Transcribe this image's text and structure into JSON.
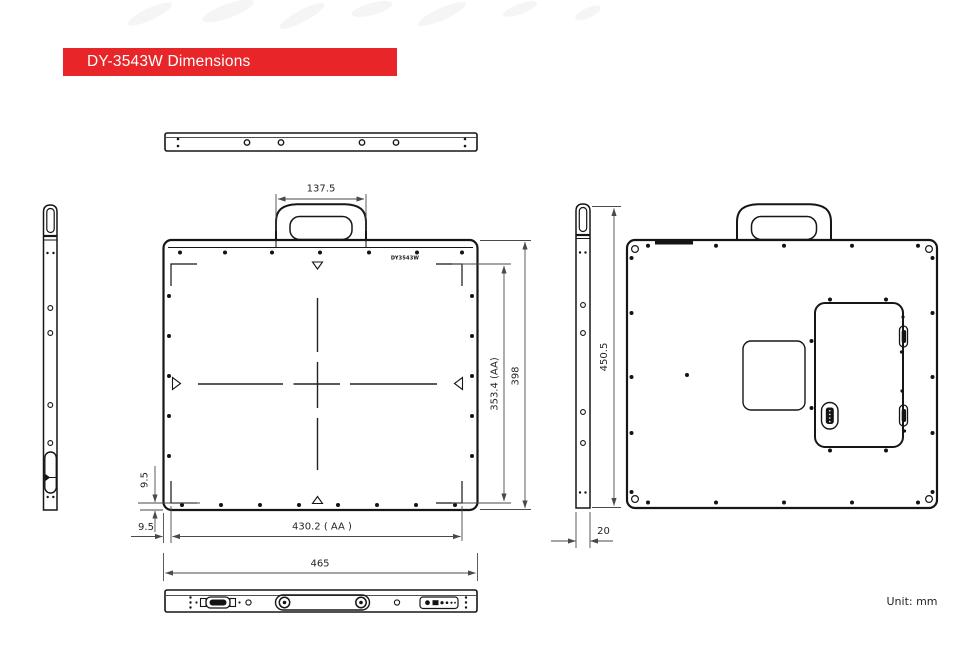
{
  "banner": {
    "title": "DY-3543W Dimensions",
    "background": "#e8262a",
    "text_color": "#ffffff"
  },
  "model_label": "DY3543W",
  "unit_label": "Unit: mm",
  "dimensions": {
    "handle_width": "137.5",
    "active_area_height": "353.4 (AA)",
    "panel_height": "398",
    "aa_offset_vertical": "9.5",
    "aa_offset_horizontal": "9.5",
    "active_area_width": "430.2 ( AA )",
    "panel_width": "465",
    "rear_height": "450.5",
    "thickness": "20"
  },
  "colors": {
    "line": "#161616",
    "dimension": "#4a4a4a",
    "accent_red": "#e8262a"
  }
}
